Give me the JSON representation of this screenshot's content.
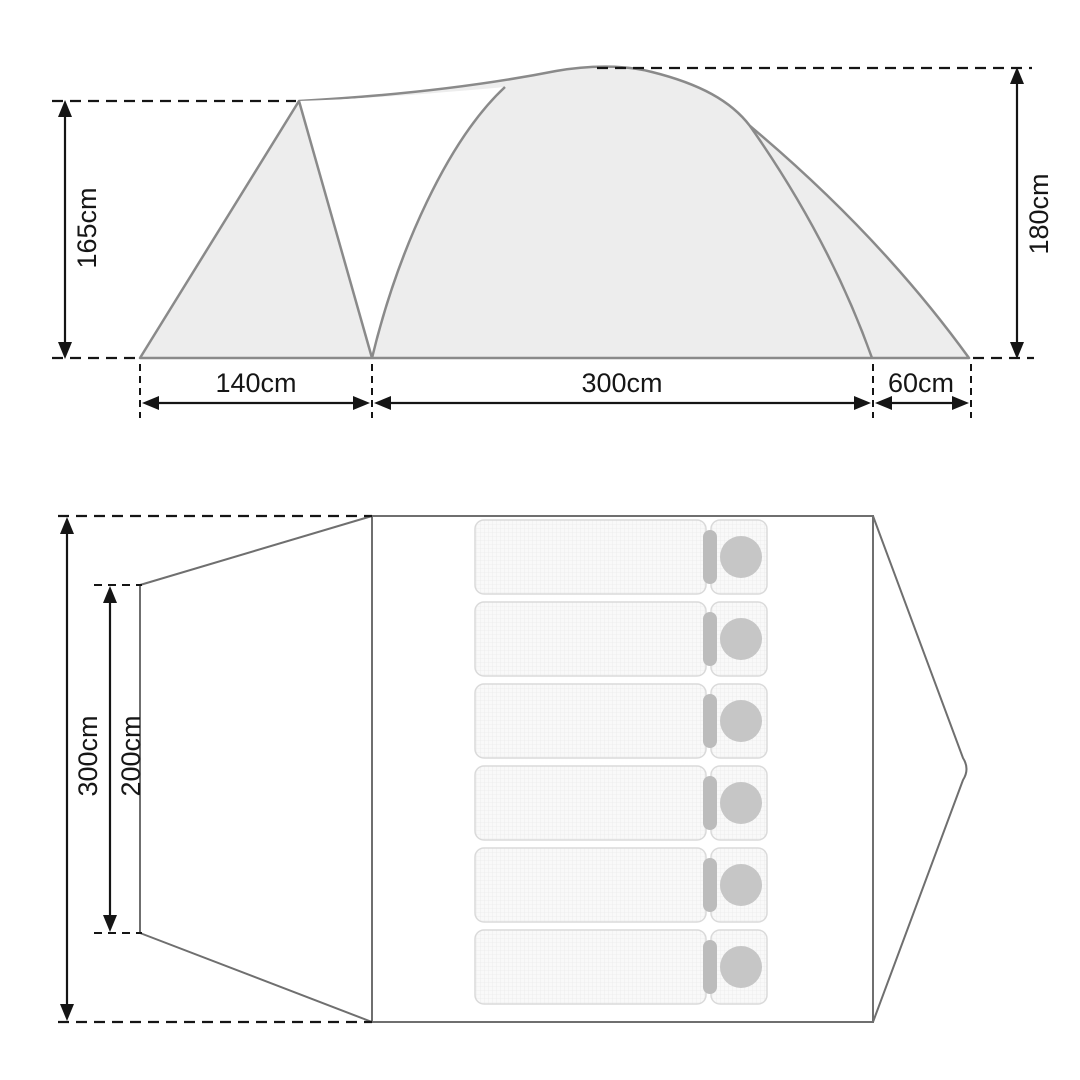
{
  "diagram": {
    "title": "tent-dimensions-diagram",
    "side_view": {
      "height_left": "165cm",
      "height_right": "180cm",
      "width_vestibule": "140cm",
      "width_body": "300cm",
      "width_rear": "60cm"
    },
    "floor_plan": {
      "depth_total": "300cm",
      "depth_inner": "200cm",
      "sleeping_bag_count": 6
    },
    "colors": {
      "tent_fill": "#ededed",
      "tent_stroke": "#8a8a8a",
      "plan_stroke": "#6f6f6f",
      "dimension_color": "#151515",
      "mat_fill": "#f9f9f9",
      "mat_border": "#dadada",
      "hood_color": "#bcbcbc",
      "pillow_color": "#c6c6c6"
    }
  }
}
